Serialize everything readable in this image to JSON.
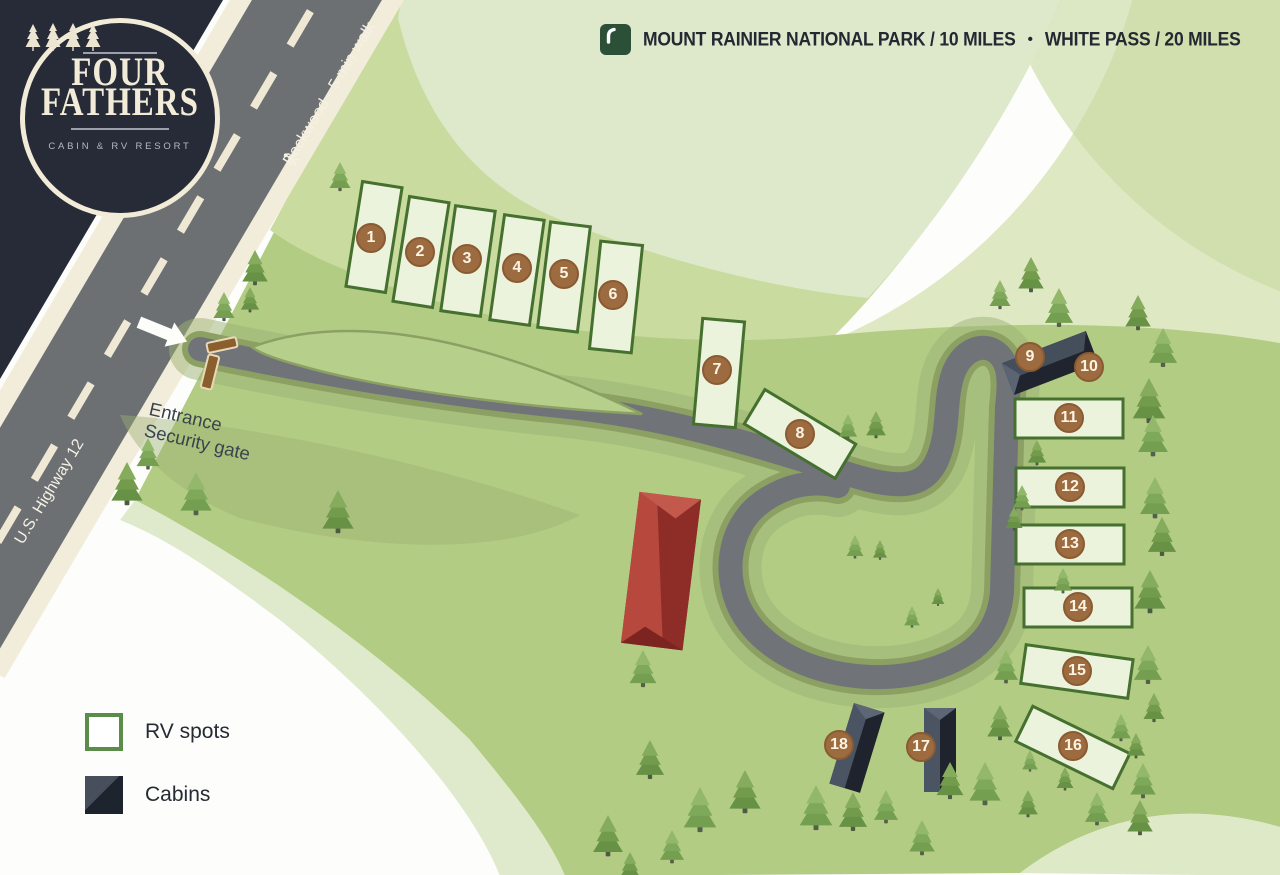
{
  "logo": {
    "title_line1": "FOUR",
    "title_line2": "FATHERS",
    "subtitle": "CABIN & RV RESORT"
  },
  "header": {
    "destination1": "MOUNT RAINIER NATIONAL PARK / 10 MILES",
    "separator": "•",
    "destination2": "WHITE PASS / 20 MILES"
  },
  "roads": {
    "highway_label": "U.S. Highway 12",
    "packwood_label": "Packwood · 5 min walk"
  },
  "entrance": {
    "line1": "Entrance",
    "line2": "Security gate"
  },
  "legend": {
    "rv_label": "RV spots",
    "cabins_label": "Cabins"
  },
  "spots": [
    {
      "n": "1",
      "type": "rv"
    },
    {
      "n": "2",
      "type": "rv"
    },
    {
      "n": "3",
      "type": "rv"
    },
    {
      "n": "4",
      "type": "rv"
    },
    {
      "n": "5",
      "type": "rv"
    },
    {
      "n": "6",
      "type": "rv"
    },
    {
      "n": "7",
      "type": "rv"
    },
    {
      "n": "8",
      "type": "rv"
    },
    {
      "n": "9",
      "type": "cabin"
    },
    {
      "n": "10",
      "type": "cabin"
    },
    {
      "n": "11",
      "type": "rv"
    },
    {
      "n": "12",
      "type": "rv"
    },
    {
      "n": "13",
      "type": "rv"
    },
    {
      "n": "14",
      "type": "rv"
    },
    {
      "n": "15",
      "type": "rv"
    },
    {
      "n": "16",
      "type": "rv"
    },
    {
      "n": "17",
      "type": "cabin"
    },
    {
      "n": "18",
      "type": "cabin"
    }
  ],
  "colors": {
    "navy": "#262b37",
    "cream": "#f2ecd9",
    "asphalt": "#6e7276",
    "road_casing": "#8da063",
    "main_green": "#b2cc84",
    "pale_green": "#dde9ca",
    "rv_fill": "#ecf3dc",
    "rv_border": "#45702f",
    "badge_brown": "#9c6b40",
    "cabin_dark": "#20252f",
    "lodge_red": "#a23a33",
    "header_green": "#2c4f38"
  }
}
